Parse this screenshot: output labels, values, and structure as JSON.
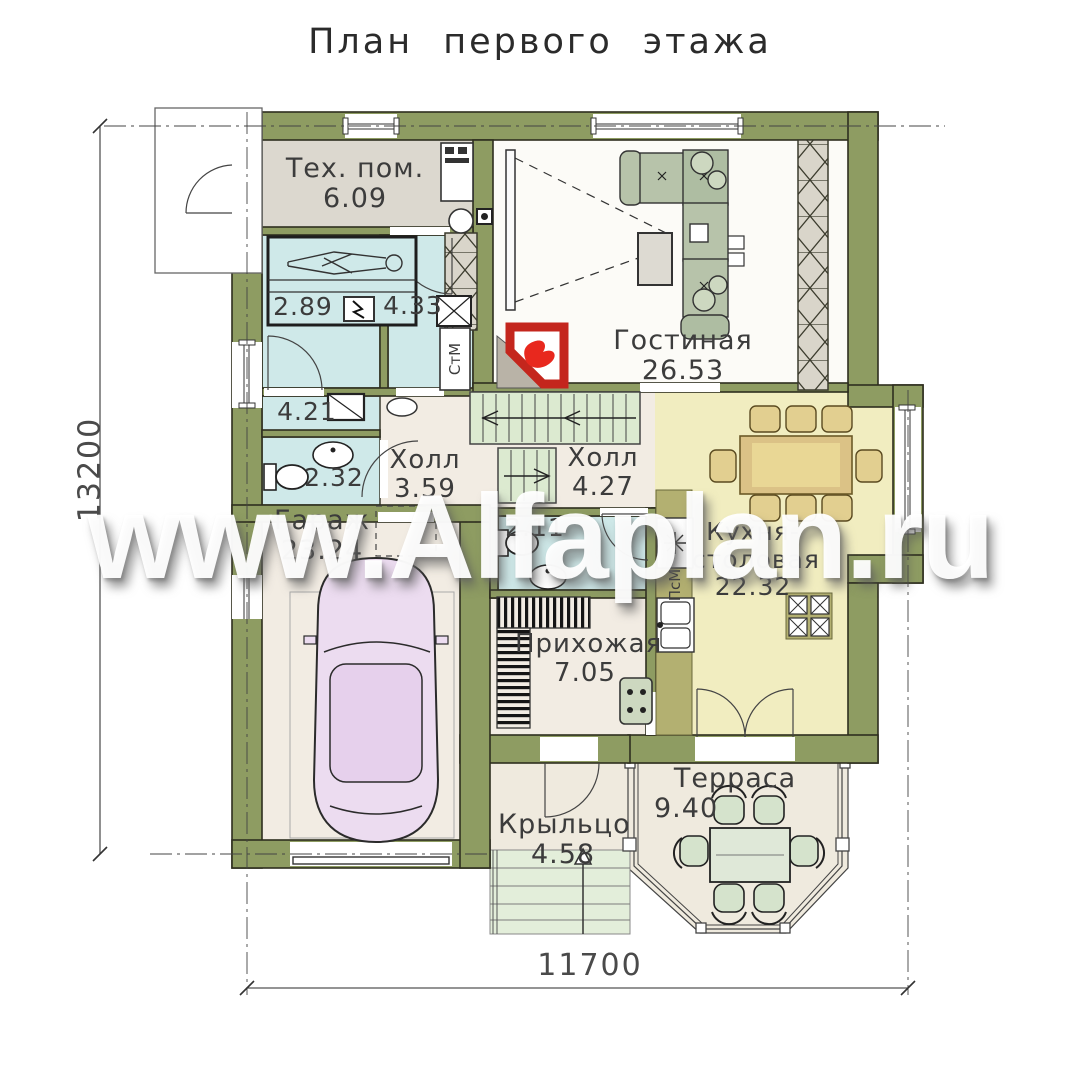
{
  "title": "План первого этажа",
  "watermark": "www.Alfaplan.ru",
  "dimensions": {
    "height": "13200",
    "width": "11700"
  },
  "rooms": {
    "tech": {
      "name": "Тех. пом.",
      "area": "6.09"
    },
    "sauna": {
      "area": "2.89"
    },
    "shower": {
      "area": "4.33"
    },
    "bath": {
      "area": "4.21"
    },
    "wc1": {
      "area": "2.32"
    },
    "living": {
      "name": "Гостиная",
      "area": "26.53"
    },
    "hall1": {
      "name": "Холл",
      "area": "3.59"
    },
    "hall2": {
      "name": "Холл",
      "area": "4.27"
    },
    "wc2": {
      "area": "2.11"
    },
    "garage": {
      "name": "Гараж",
      "area": "23.24"
    },
    "entry": {
      "name": "Прихожая",
      "area": "7.05"
    },
    "kitchen": {
      "name": "Кухня-столовая",
      "area": "22.32"
    },
    "porch": {
      "name": "Крыльцо",
      "area": "4.58"
    },
    "terrace": {
      "name": "Терраса",
      "area": "9.40"
    }
  },
  "appliances": {
    "washing_machine": "СтМ",
    "dishwasher": "ПсМ"
  },
  "colors": {
    "wall": "#8e9c62",
    "wet_room": "#cfe9e9",
    "kitchen": "#f1edc0",
    "living": "#fcfbf7",
    "tech": "#dcd8cf",
    "floor": "#f2ece3",
    "stairs": "#dcead0",
    "fireplace_red": "#c4261d",
    "car": "#ecdcf0",
    "sofa": "#b7c3aa",
    "table_wood": "#dbc286",
    "watermark_text": "#ffffff"
  }
}
